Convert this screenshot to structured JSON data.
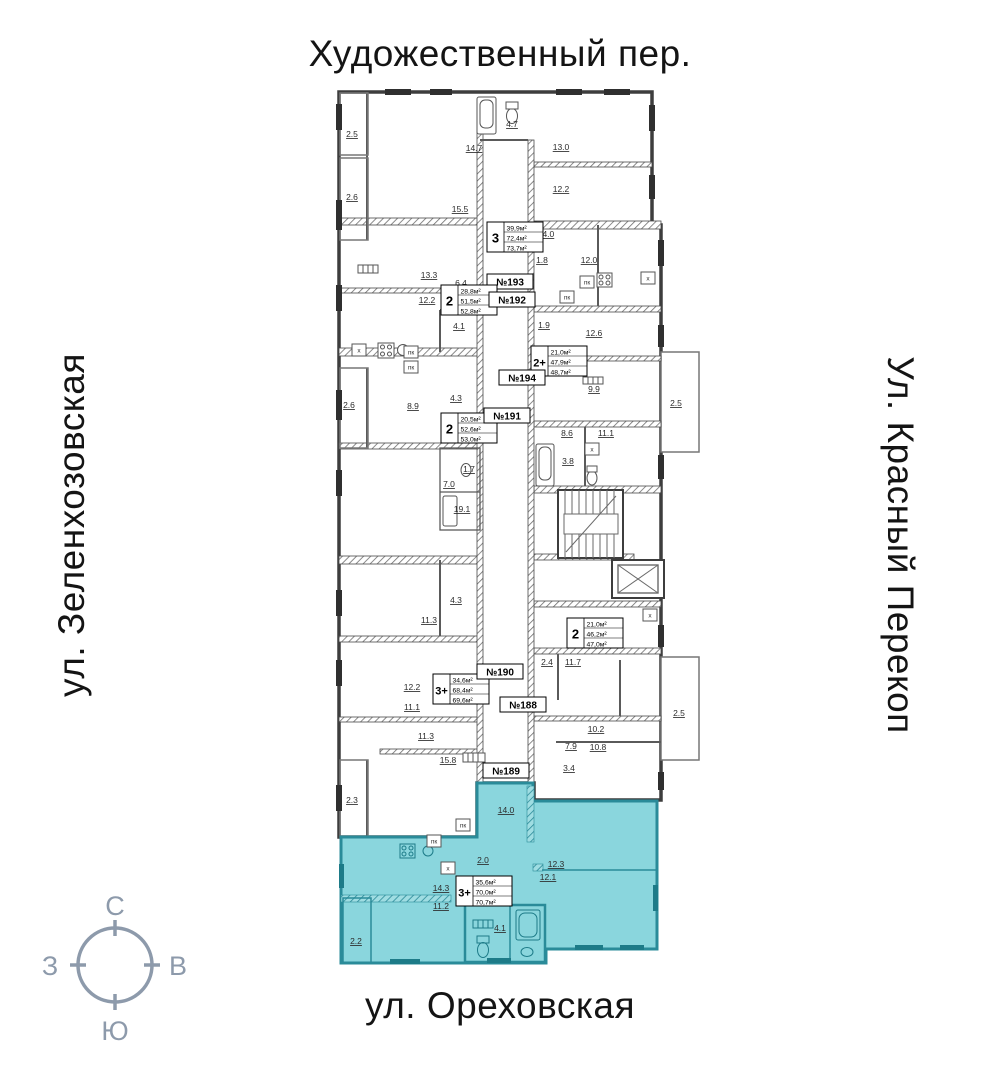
{
  "streets": {
    "top": "Художественный пер.",
    "left": "ул. Зеленхозовская",
    "right": "Ул. Красный Перекоп",
    "bottom": "ул. Ореховская"
  },
  "compass": {
    "north": "С",
    "south": "Ю",
    "west": "З",
    "east": "В",
    "color": "#8d9aab"
  },
  "plan": {
    "colors": {
      "highlight_fill": "#8ad6dd",
      "highlight_wall": "#2a8b99",
      "wall": "#3d3d3d"
    },
    "apartments": [
      {
        "id": "193",
        "number": "№193",
        "type": "3",
        "areas": [
          "39,9м²",
          "72,4м²",
          "73,7м²"
        ],
        "highlighted": false,
        "info_x": 487,
        "info_y": 222,
        "tag_x": 487,
        "tag_y": 274
      },
      {
        "id": "192",
        "number": "№192",
        "type": "2",
        "areas": [
          "28,8м²",
          "51,5м²",
          "52,8м²"
        ],
        "highlighted": false,
        "info_x": 441,
        "info_y": 285,
        "tag_x": 489,
        "tag_y": 292
      },
      {
        "id": "194",
        "number": "№194",
        "type": "2+",
        "areas": [
          "21,0м²",
          "47,9м²",
          "48,7м²"
        ],
        "highlighted": false,
        "info_x": 531,
        "info_y": 346,
        "tag_x": 499,
        "tag_y": 370
      },
      {
        "id": "191",
        "number": "№191",
        "type": "2",
        "areas": [
          "20,5м²",
          "52,6м²",
          "53,0м²"
        ],
        "highlighted": false,
        "info_x": 441,
        "info_y": 413,
        "tag_x": 484,
        "tag_y": 408
      },
      {
        "id": "190",
        "number": "№190",
        "type": "3+",
        "areas": [
          "34,6м²",
          "68,4м²",
          "69,6м²"
        ],
        "highlighted": false,
        "info_x": 433,
        "info_y": 674,
        "tag_x": 477,
        "tag_y": 664
      },
      {
        "id": "188",
        "number": "№188",
        "type": "2",
        "areas": [
          "21,0м²",
          "46,2м²",
          "47,0м²"
        ],
        "highlighted": false,
        "info_x": 567,
        "info_y": 618,
        "tag_x": 500,
        "tag_y": 697
      },
      {
        "id": "189",
        "number": "№189",
        "type": "3+",
        "areas": [
          "35,6м²",
          "70,0м²",
          "70,7м²"
        ],
        "highlighted": true,
        "info_x": 456,
        "info_y": 876,
        "tag_x": 483,
        "tag_y": 763
      }
    ],
    "room_areas": [
      {
        "value": "2.5",
        "x": 352,
        "y": 134
      },
      {
        "value": "2.6",
        "x": 352,
        "y": 197
      },
      {
        "value": "15.5",
        "x": 460,
        "y": 209
      },
      {
        "value": "14.7",
        "x": 474,
        "y": 148
      },
      {
        "value": "4.7",
        "x": 512,
        "y": 124
      },
      {
        "value": "13.0",
        "x": 561,
        "y": 147
      },
      {
        "value": "12.2",
        "x": 561,
        "y": 189
      },
      {
        "value": "13.3",
        "x": 429,
        "y": 275
      },
      {
        "value": "6.4",
        "x": 461,
        "y": 283
      },
      {
        "value": "12.2",
        "x": 427,
        "y": 300
      },
      {
        "value": "14.0",
        "x": 546,
        "y": 234
      },
      {
        "value": "1.8",
        "x": 542,
        "y": 260
      },
      {
        "value": "12.0",
        "x": 589,
        "y": 260
      },
      {
        "value": "4.1",
        "x": 459,
        "y": 326
      },
      {
        "value": "1.9",
        "x": 544,
        "y": 325
      },
      {
        "value": "12.6",
        "x": 594,
        "y": 333
      },
      {
        "value": "2.6",
        "x": 349,
        "y": 405
      },
      {
        "value": "8.9",
        "x": 413,
        "y": 406
      },
      {
        "value": "4.3",
        "x": 456,
        "y": 398
      },
      {
        "value": "9.9",
        "x": 594,
        "y": 389
      },
      {
        "value": "2.5",
        "x": 676,
        "y": 403
      },
      {
        "value": "8.6",
        "x": 567,
        "y": 433
      },
      {
        "value": "11.1",
        "x": 606,
        "y": 433
      },
      {
        "value": "3.8",
        "x": 568,
        "y": 461
      },
      {
        "value": "1.7",
        "x": 469,
        "y": 469
      },
      {
        "value": "7.0",
        "x": 449,
        "y": 484
      },
      {
        "value": "19.1",
        "x": 462,
        "y": 509
      },
      {
        "value": "4.3",
        "x": 456,
        "y": 600
      },
      {
        "value": "11.3",
        "x": 429,
        "y": 620
      },
      {
        "value": "2.4",
        "x": 547,
        "y": 662
      },
      {
        "value": "11.7",
        "x": 573,
        "y": 662
      },
      {
        "value": "12.2",
        "x": 412,
        "y": 687
      },
      {
        "value": "11.1",
        "x": 412,
        "y": 707
      },
      {
        "value": "10.2",
        "x": 596,
        "y": 729
      },
      {
        "value": "11.3",
        "x": 426,
        "y": 736
      },
      {
        "value": "7.9",
        "x": 571,
        "y": 746
      },
      {
        "value": "10.8",
        "x": 598,
        "y": 747
      },
      {
        "value": "15.8",
        "x": 448,
        "y": 760
      },
      {
        "value": "3.4",
        "x": 569,
        "y": 768
      },
      {
        "value": "2.5",
        "x": 679,
        "y": 713
      },
      {
        "value": "2.3",
        "x": 352,
        "y": 800
      },
      {
        "value": "14.0",
        "x": 506,
        "y": 810
      },
      {
        "value": "2.0",
        "x": 483,
        "y": 860
      },
      {
        "value": "12.3",
        "x": 556,
        "y": 864
      },
      {
        "value": "12.1",
        "x": 548,
        "y": 877
      },
      {
        "value": "14.3",
        "x": 441,
        "y": 888
      },
      {
        "value": "11.2",
        "x": 441,
        "y": 906
      },
      {
        "value": "4.1",
        "x": 500,
        "y": 928
      },
      {
        "value": "2.2",
        "x": 356,
        "y": 941
      }
    ],
    "fixtures": [
      {
        "value": "х",
        "x": 359,
        "y": 350
      },
      {
        "value": "х",
        "x": 648,
        "y": 278
      },
      {
        "value": "х",
        "x": 650,
        "y": 615
      },
      {
        "value": "х",
        "x": 592,
        "y": 449
      },
      {
        "value": "х",
        "x": 448,
        "y": 868
      },
      {
        "value": "пк",
        "x": 587,
        "y": 282
      },
      {
        "value": "пк",
        "x": 567,
        "y": 297
      },
      {
        "value": "пк",
        "x": 411,
        "y": 352
      },
      {
        "value": "пк",
        "x": 411,
        "y": 367
      },
      {
        "value": "пк",
        "x": 463,
        "y": 825
      },
      {
        "value": "пк",
        "x": 434,
        "y": 841
      }
    ]
  }
}
